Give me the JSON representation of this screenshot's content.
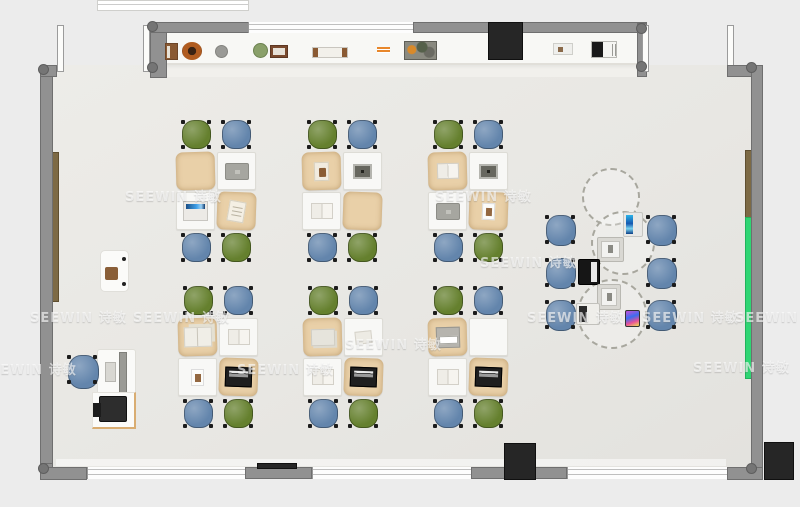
{
  "watermark": {
    "text": "SEEWIN 诗敏",
    "positions": [
      [
        125,
        186
      ],
      [
        435,
        186
      ],
      [
        30,
        307
      ],
      [
        133,
        307
      ],
      [
        345,
        334
      ],
      [
        527,
        307
      ],
      [
        642,
        307
      ],
      [
        735,
        307
      ],
      [
        -20,
        359
      ],
      [
        237,
        359
      ],
      [
        693,
        357
      ],
      [
        480,
        252
      ]
    ]
  },
  "colors": {
    "wall": "#919191",
    "board-green": "#2fd573",
    "chair-blue": "#6385ac",
    "chair-green": "#65802e",
    "desk-tan": "#e9d0a8",
    "desk-white": "#f8f8f6",
    "tv-black": "#262626"
  },
  "furniture": {
    "cluster_layout": {
      "chair_w": 33,
      "chair_h": 31,
      "desk_w": 39,
      "desk_h": 38,
      "chairs": [
        {
          "x": 4,
          "y": 0,
          "c": "green"
        },
        {
          "x": 44,
          "y": 0,
          "c": "blue"
        },
        {
          "x": 4,
          "y": 113,
          "c": "blue"
        },
        {
          "x": 44,
          "y": 113,
          "c": "green"
        }
      ],
      "desks": [
        {
          "x": 0,
          "y": 33,
          "t": "tan",
          "r": -1.5
        },
        {
          "x": 41,
          "y": 33,
          "t": "white",
          "r": 0
        },
        {
          "x": 0,
          "y": 73,
          "t": "white",
          "r": 0
        },
        {
          "x": 41,
          "y": 73,
          "t": "tan",
          "r": 2
        }
      ]
    },
    "clusters": [
      {
        "x": 176,
        "y": 119,
        "items": [
          "",
          "laptop-gray",
          "laptop-open",
          "notebook"
        ]
      },
      {
        "x": 302,
        "y": 119,
        "items": [
          "book-closed",
          "tablet-dark",
          "book-open",
          ""
        ]
      },
      {
        "x": 428,
        "y": 119,
        "items": [
          "book-open",
          "tablet-dark",
          "laptop-gray",
          "photo-card"
        ]
      },
      {
        "x": 178,
        "y": 285,
        "items": [
          "books-open",
          "book-open",
          "photo-card",
          "laptop-black"
        ]
      },
      {
        "x": 303,
        "y": 285,
        "items": [
          "papers",
          "paper",
          "book-open",
          "laptop-black"
        ]
      },
      {
        "x": 428,
        "y": 285,
        "items": [
          "device-white",
          "",
          "book-open",
          "laptop-black"
        ]
      }
    ],
    "right_zone": {
      "chairs": [
        [
          544,
          214
        ],
        [
          544,
          257
        ],
        [
          544,
          299
        ],
        [
          645,
          214
        ],
        [
          645,
          257
        ],
        [
          645,
          299
        ]
      ],
      "circles": [
        {
          "x": 582,
          "y": 168,
          "d": 58
        },
        {
          "x": 591,
          "y": 211,
          "d": 64
        },
        {
          "x": 577,
          "y": 279,
          "d": 70
        }
      ],
      "devices": [
        {
          "t": "tablet-blue",
          "x": 623,
          "y": 212,
          "w": 20,
          "h": 25
        },
        {
          "t": "tablet-frame",
          "x": 597,
          "y": 237,
          "w": 27,
          "h": 25
        },
        {
          "t": "laptop-black-v",
          "x": 578,
          "y": 259,
          "w": 22,
          "h": 26
        },
        {
          "t": "tablet-frame",
          "x": 597,
          "y": 284,
          "w": 24,
          "h": 26
        },
        {
          "t": "laptop-white",
          "x": 576,
          "y": 303,
          "w": 24,
          "h": 22
        },
        {
          "t": "phone-color",
          "x": 625,
          "y": 310,
          "w": 15,
          "h": 17
        }
      ]
    },
    "teacher_zone": [
      {
        "t": "cabinet",
        "x": 100,
        "y": 250,
        "w": 29,
        "h": 42
      },
      {
        "t": "tdesk",
        "x": 97,
        "y": 349,
        "w": 39,
        "h": 46
      },
      {
        "t": "ptable",
        "x": 92,
        "y": 392,
        "w": 44,
        "h": 37
      },
      {
        "t": "printer",
        "x": 99,
        "y": 396,
        "w": 28,
        "h": 26
      },
      {
        "t": "chair",
        "x": 66,
        "y": 354,
        "w": 35,
        "h": 36
      }
    ],
    "shelf_items": [
      {
        "t": "box-brown",
        "x": 165,
        "y": 43,
        "w": 13,
        "h": 17
      },
      {
        "t": "bowl-brown",
        "x": 182,
        "y": 42,
        "w": 20,
        "h": 18
      },
      {
        "t": "circle-gray",
        "x": 215,
        "y": 45,
        "w": 13,
        "h": 13
      },
      {
        "t": "circle-green",
        "x": 253,
        "y": 43,
        "w": 15,
        "h": 15
      },
      {
        "t": "frame-photo",
        "x": 270,
        "y": 45,
        "w": 18,
        "h": 13
      },
      {
        "t": "books-stack",
        "x": 312,
        "y": 47,
        "w": 36,
        "h": 11
      },
      {
        "t": "sticks-orange",
        "x": 377,
        "y": 47,
        "w": 13,
        "h": 6
      },
      {
        "t": "tray-clutter",
        "x": 404,
        "y": 41,
        "w": 33,
        "h": 19
      },
      {
        "t": "box-white",
        "x": 553,
        "y": 43,
        "w": 20,
        "h": 12
      },
      {
        "t": "books-bw",
        "x": 591,
        "y": 41,
        "w": 26,
        "h": 17
      }
    ]
  }
}
